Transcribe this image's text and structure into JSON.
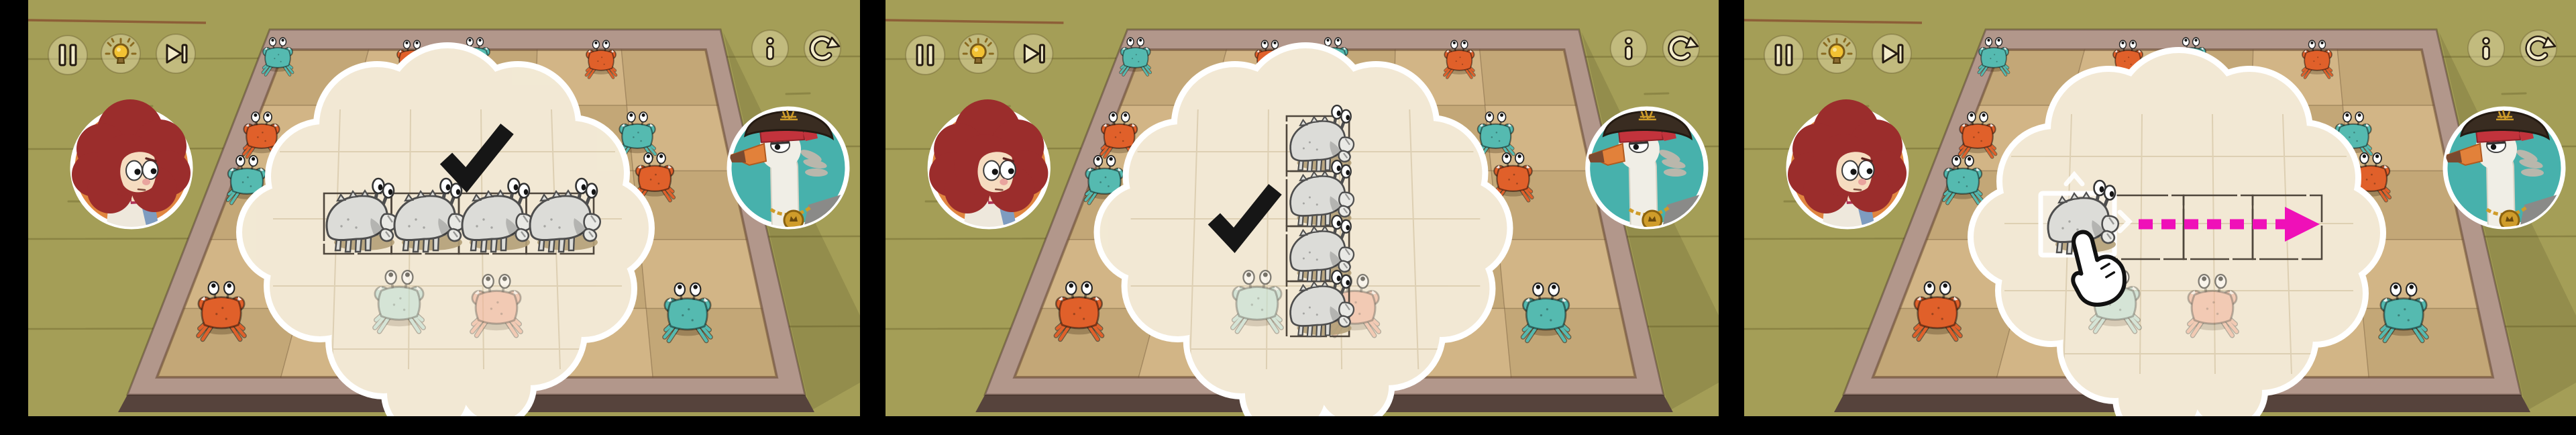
{
  "app": {
    "name": "crab puzzle tutorial strip",
    "frame_count": 3
  },
  "frames": [
    {
      "id": "frame-1",
      "bubble": {
        "type": "thought-bubble",
        "icon": "checkmark-icon",
        "meaning": "valid arrangement",
        "arrangement": "horizontal-row-of-4",
        "ghost_crabs": 4
      }
    },
    {
      "id": "frame-2",
      "bubble": {
        "type": "thought-bubble",
        "icon": "checkmark-icon",
        "meaning": "valid arrangement",
        "arrangement": "vertical-column-of-4",
        "ghost_crabs": 4
      }
    },
    {
      "id": "frame-3",
      "bubble": {
        "type": "thought-bubble",
        "icon": "hand-cursor-icon",
        "meaning": "drag crab to the right",
        "arrangement": "single-crab-drag",
        "ghost_crabs": 1,
        "arrow_direction": "right",
        "empty_target_tiles": 3
      }
    }
  ],
  "hud": {
    "pause_label": "Pause",
    "hint_label": "Hint",
    "skip_label": "Skip",
    "info_label": "Info",
    "restart_label": "Restart"
  },
  "avatars": {
    "left_label": "red-haired girl player",
    "right_label": "captain seagull with pirate hat"
  },
  "board": {
    "grid": "5x5",
    "edge_crabs": {
      "top": [
        "teal",
        "orange",
        "teal",
        "orange"
      ],
      "left": [
        "orange",
        "teal"
      ],
      "right": [
        "teal",
        "orange"
      ],
      "bottom_corners": [
        "orange",
        "teal"
      ],
      "under_bubble": [
        "faded-teal",
        "faded-salmon"
      ]
    }
  },
  "colors": {
    "bg_olive": "#a49e57",
    "plank_line": "#6f6830",
    "frame_light": "#b2978b",
    "frame_dark": "#56433c",
    "frame_inner": "#c9afa2",
    "board_tan_1": "#d2b586",
    "board_tan_2": "#c3a777",
    "bubble_cream": "#f2e8d3",
    "crab_teal": "#55bab0",
    "crab_orange": "#e0602a",
    "crab_gray": "#dcdcd8",
    "crab_gray_line": "#4e4e4e",
    "crab_faded_teal": "#bfe2d8",
    "crab_faded_salmon": "#f2b29a",
    "arrow_magenta": "#ef10b8",
    "ink": "#161616",
    "btn_icon": "#f3ecca",
    "btn_outline": "#241a10",
    "bulb_yellow": "#f2c233",
    "avatar_girl_bg": "#e0853f",
    "avatar_gull_bg": "#47b1ac",
    "hair_red": "#9b2d2c",
    "skin": "#f6dcc0",
    "gull_white": "#f0eee6",
    "hat_brown": "#392c21",
    "bandana_red": "#c2333c",
    "gold": "#cf9c2a",
    "ghost_shadow": "#b4a078"
  }
}
